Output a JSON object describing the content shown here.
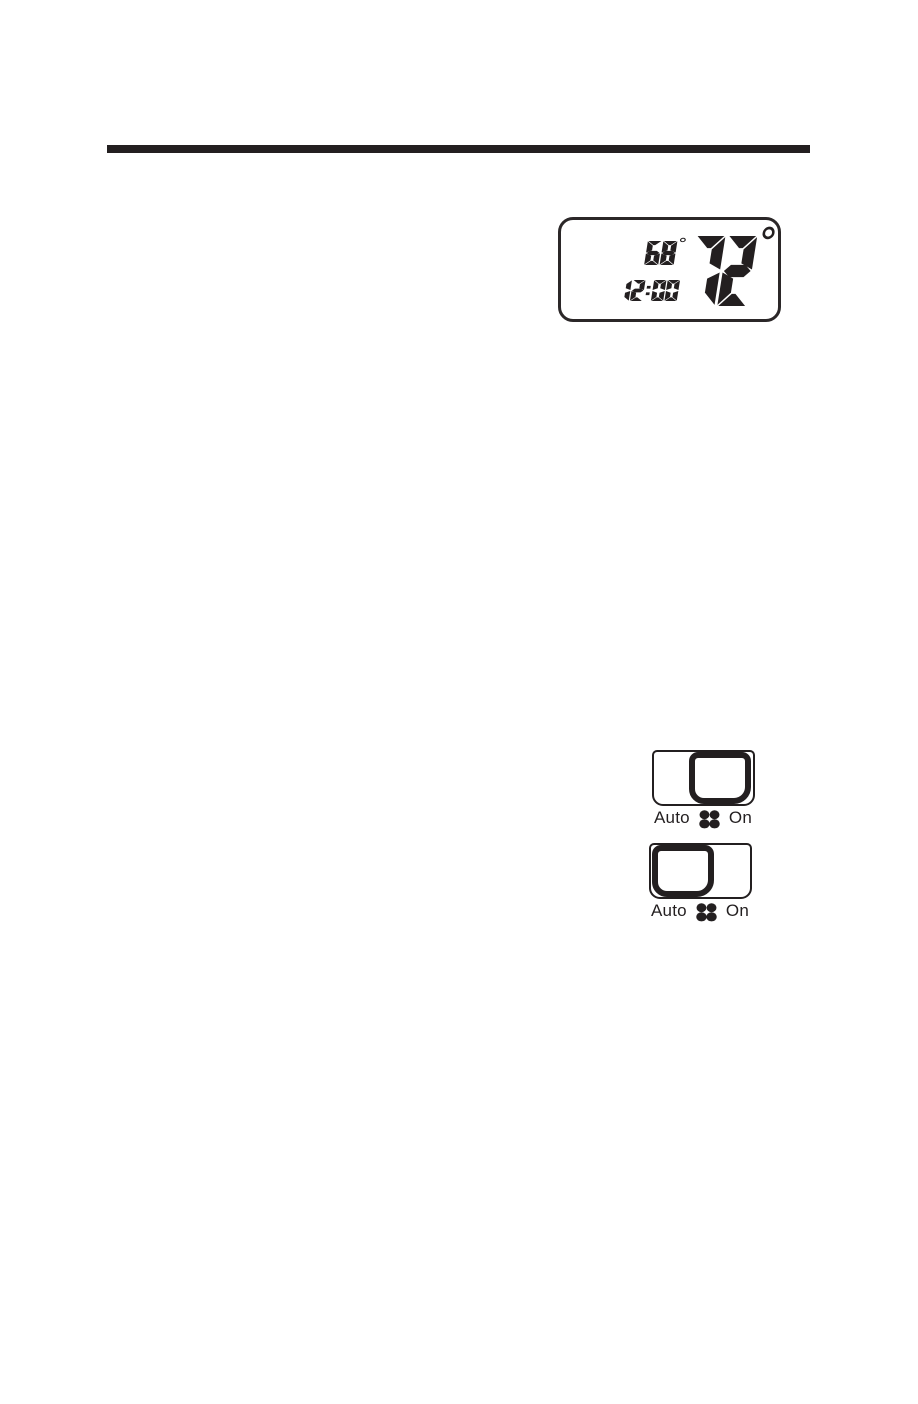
{
  "colors": {
    "ink": "#231f20",
    "background": "#ffffff"
  },
  "thermostat_display": {
    "set_temperature": "68°",
    "time": "12:00",
    "room_temperature": "72°"
  },
  "fan_switches": [
    {
      "left_label": "Auto",
      "right_label": "On",
      "icon": "fan-icon",
      "knob_position": "on"
    },
    {
      "left_label": "Auto",
      "right_label": "On",
      "icon": "fan-icon",
      "knob_position": "auto"
    }
  ]
}
